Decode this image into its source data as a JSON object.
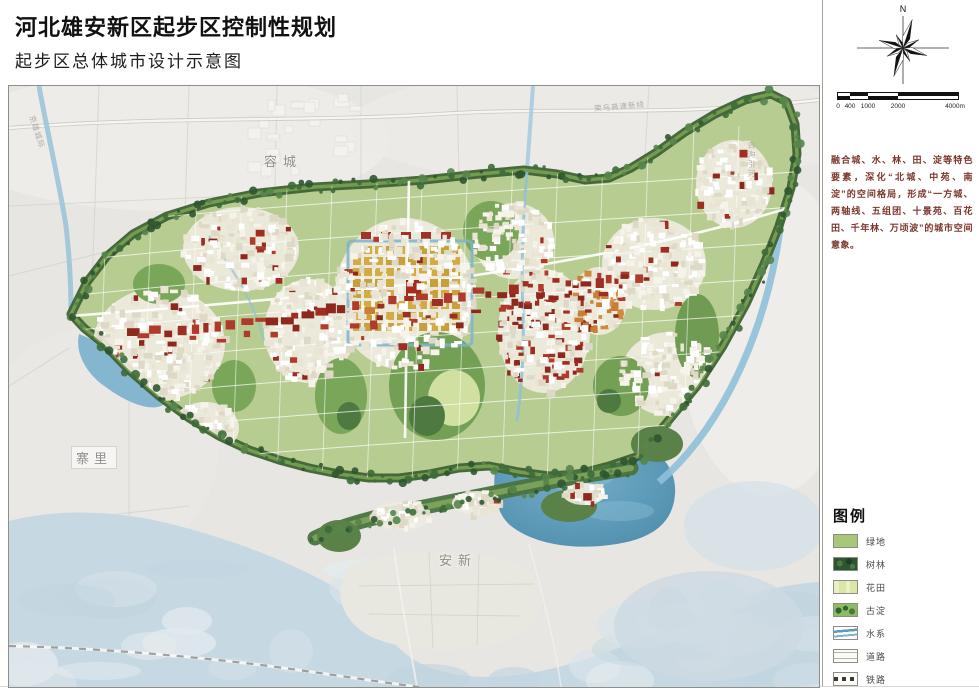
{
  "header": {
    "title": "河北雄安新区起步区控制性规划",
    "subtitle": "起步区总体城市设计示意图"
  },
  "sidebar": {
    "north_label": "N",
    "scale_labels": [
      "0",
      "400",
      "1000",
      "2000",
      "4000m"
    ],
    "description": "融合城、水、林、田、淀等特色要素，深化“北城、中苑、南淀”的空间格局，形成“一方城、两轴线、五组团、十景苑、百花田、千年林、万顷波”的城市空间意象。",
    "legend": {
      "title": "图例",
      "items": [
        {
          "label": "绿地",
          "type": "greenspace",
          "color": "#a6c878"
        },
        {
          "label": "树林",
          "type": "forest",
          "color": "#2c5530"
        },
        {
          "label": "花田",
          "type": "flowerfield",
          "color": "#d9e6a6"
        },
        {
          "label": "古淀",
          "type": "marsh",
          "color": "#8cbd63"
        },
        {
          "label": "水系",
          "type": "water",
          "color": "#5b9bc0"
        },
        {
          "label": "道路",
          "type": "road",
          "color": "#ffffff"
        },
        {
          "label": "铁路",
          "type": "railway",
          "color": "#ffffff"
        }
      ]
    }
  },
  "map": {
    "labels": [
      {
        "text": "容城"
      },
      {
        "text": "寨里"
      },
      {
        "text": "安新"
      },
      {
        "text": "荣乌高速新线"
      },
      {
        "text": "白沟引河"
      },
      {
        "text": "京雄城际"
      }
    ],
    "colors": {
      "greenspace": "#b7cc90",
      "forest_belt": "#3f6234",
      "marsh": "#c6d8e2",
      "water_deep": "#5e9cba",
      "urban_red": "#9e2d22",
      "urban_gold": "#c79f3b"
    }
  }
}
